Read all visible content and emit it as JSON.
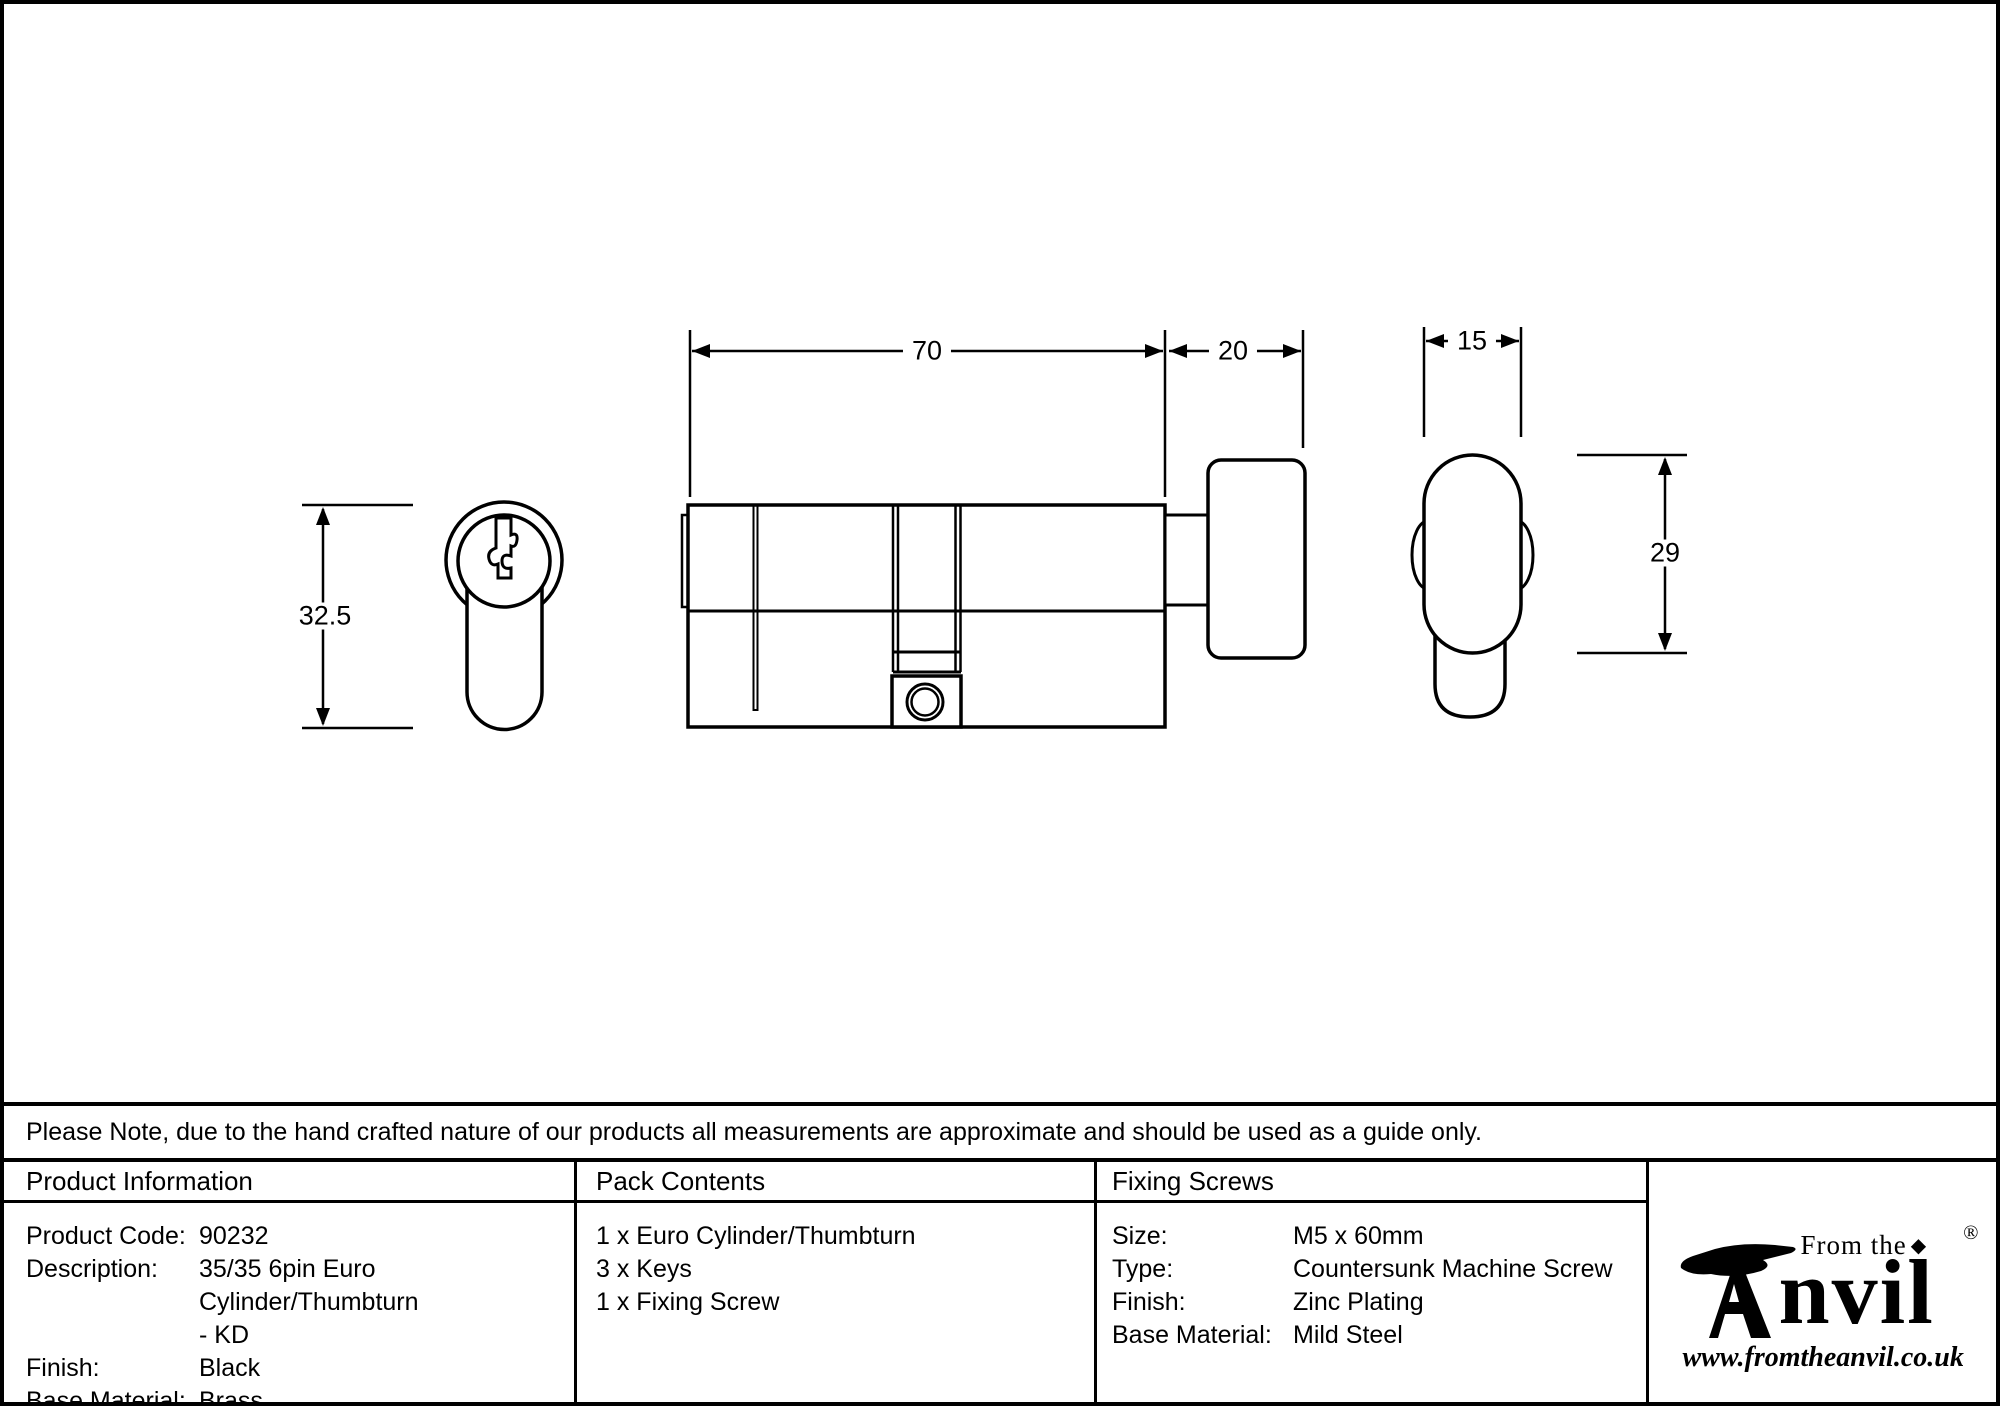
{
  "note": {
    "text": "Please Note, due to the hand crafted nature of our products all measurements are approximate and should be used as a guide only."
  },
  "drawing": {
    "dimensions": {
      "body_length": "70",
      "thumbturn_length": "20",
      "thumbturn_width": "15",
      "profile_height": "32.5",
      "thumbturn_height": "29"
    }
  },
  "table": {
    "columns": [
      {
        "header": "Product Information",
        "rows": [
          {
            "label": "Product Code:",
            "value": "90232"
          },
          {
            "label": "Description:",
            "value": "35/35 6pin Euro Cylinder/Thumbturn\n- KD"
          },
          {
            "label": "Finish:",
            "value": "Black"
          },
          {
            "label": "Base Material:",
            "value": "Brass"
          }
        ]
      },
      {
        "header": "Pack Contents",
        "items": [
          "1 x Euro Cylinder/Thumbturn",
          "3 x Keys",
          "1 x Fixing Screw"
        ]
      },
      {
        "header": "Fixing Screws",
        "rows": [
          {
            "label": "Size:",
            "value": "M5 x 60mm"
          },
          {
            "label": "Type:",
            "value": "Countersunk Machine Screw"
          },
          {
            "label": "Finish:",
            "value": "Zinc Plating"
          },
          {
            "label": "Base Material:",
            "value": "Mild Steel"
          }
        ]
      }
    ]
  },
  "logo": {
    "top_text": "From the",
    "diamond": "◆",
    "name": "nvil",
    "registered": "®",
    "url": "www.fromtheanvil.co.uk"
  }
}
